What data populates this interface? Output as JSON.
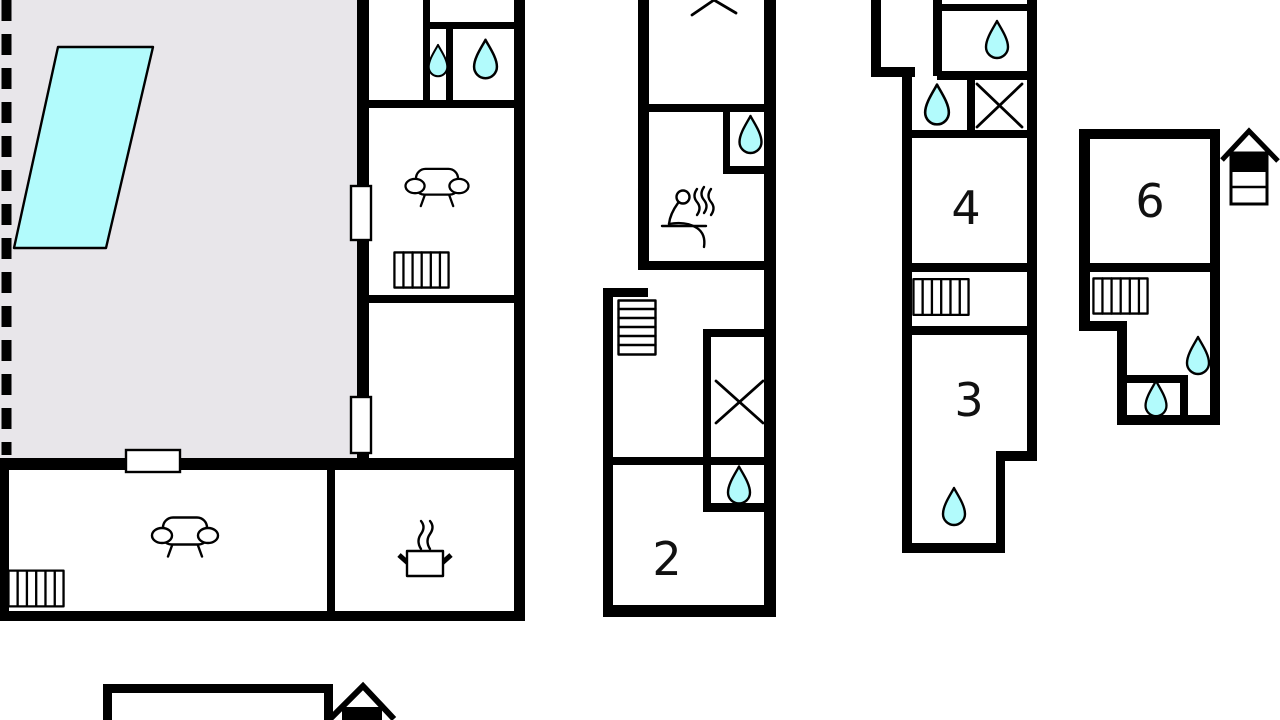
{
  "page": {
    "type": "holiday-home-floor-plan",
    "background": "#ffffff"
  },
  "colors": {
    "wall": "#000000",
    "terrace_fill": "#e8e6ea",
    "water_fill": "#b2fbfc",
    "label": "#111111"
  },
  "rooms": [
    {
      "id": "room-2",
      "label": "2"
    },
    {
      "id": "room-3",
      "label": "3"
    },
    {
      "id": "room-4",
      "label": "4"
    },
    {
      "id": "room-6",
      "label": "6"
    }
  ],
  "areas": {
    "terrace": "terrace-with-pool",
    "pool": "swimming-pool"
  },
  "icons": {
    "water_drop_count": 9,
    "radiator_count": 4,
    "sofa_count": 2,
    "wardrobe_x_count": 3,
    "stairs_count": 1,
    "sauna_count": 1,
    "cooking_pot_count": 1,
    "stove_count": 2
  }
}
